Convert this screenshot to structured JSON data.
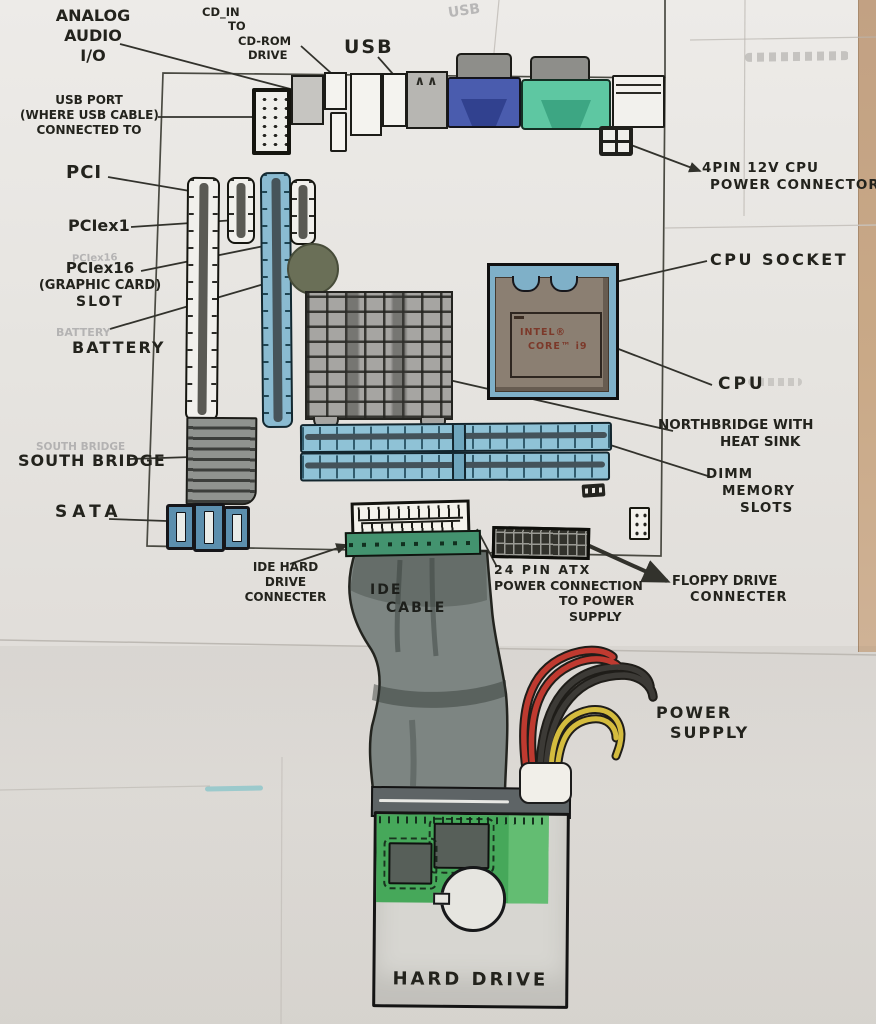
{
  "labels": {
    "analog_audio": [
      "ANALOG",
      "AUDIO",
      "I/O"
    ],
    "cd_in": [
      "CD_IN",
      "TO",
      "CD-ROM",
      "DRIVE"
    ],
    "usb": "USB",
    "usb_port": [
      "USB PORT",
      "(WHERE USB CABLE)",
      "CONNECTED TO"
    ],
    "pci": "PCI",
    "pciex1": "PCIex1",
    "pciex16": [
      "PCIex16",
      "(GRAPHIC CARD)",
      "SLOT"
    ],
    "battery": "BATTERY",
    "southbridge": "SOUTH BRIDGE",
    "sata": "SATA",
    "ide_connector": [
      "IDE HARD",
      "DRIVE",
      "CONNECTER"
    ],
    "ide_cable": [
      "IDE",
      "CABLE"
    ],
    "atx_power": [
      "24 PIN ATX",
      "POWER CONNECTION",
      "TO POWER",
      "SUPPLY"
    ],
    "floppy": [
      "FLOPPY DRIVE",
      "CONNECTER"
    ],
    "cpu_power": [
      "4PIN 12V CPU",
      "POWER CONNECTOR"
    ],
    "cpu_socket": "CPU SOCKET",
    "cpu": "CPU",
    "northbridge": [
      "NORTHBRIDGE WITH",
      "HEAT SINK"
    ],
    "dimm": [
      "DIMM",
      "MEMORY",
      "SLOTS"
    ],
    "power_supply": [
      "POWER",
      "SUPPLY"
    ],
    "hard_drive": "HARD DRIVE"
  },
  "cpu_marking": [
    "INTEL®",
    "CORE™ i9"
  ],
  "ghost_labels": {
    "usb": "USB",
    "battery": "BATTERY",
    "southbridge": "SOUTH BRIDGE",
    "pciex16": "PCIex16"
  },
  "colors": {
    "ink": "#23231d",
    "slot_blue": "#8abbd1",
    "vga_blue": "#4a5cae",
    "teal_port": "#5ec7a2",
    "socket_body": "#8b7f72",
    "heatsink_gray": "#a6a5a2",
    "pcb_green": "#46a85a",
    "ide_green": "#43936f",
    "ribbon_gray": "#7d8582",
    "wire_red": "#bf3a30",
    "wire_black": "#3c3a36",
    "wire_yellow": "#d4bc3e",
    "paper_edge_tan": "#c5a484"
  }
}
